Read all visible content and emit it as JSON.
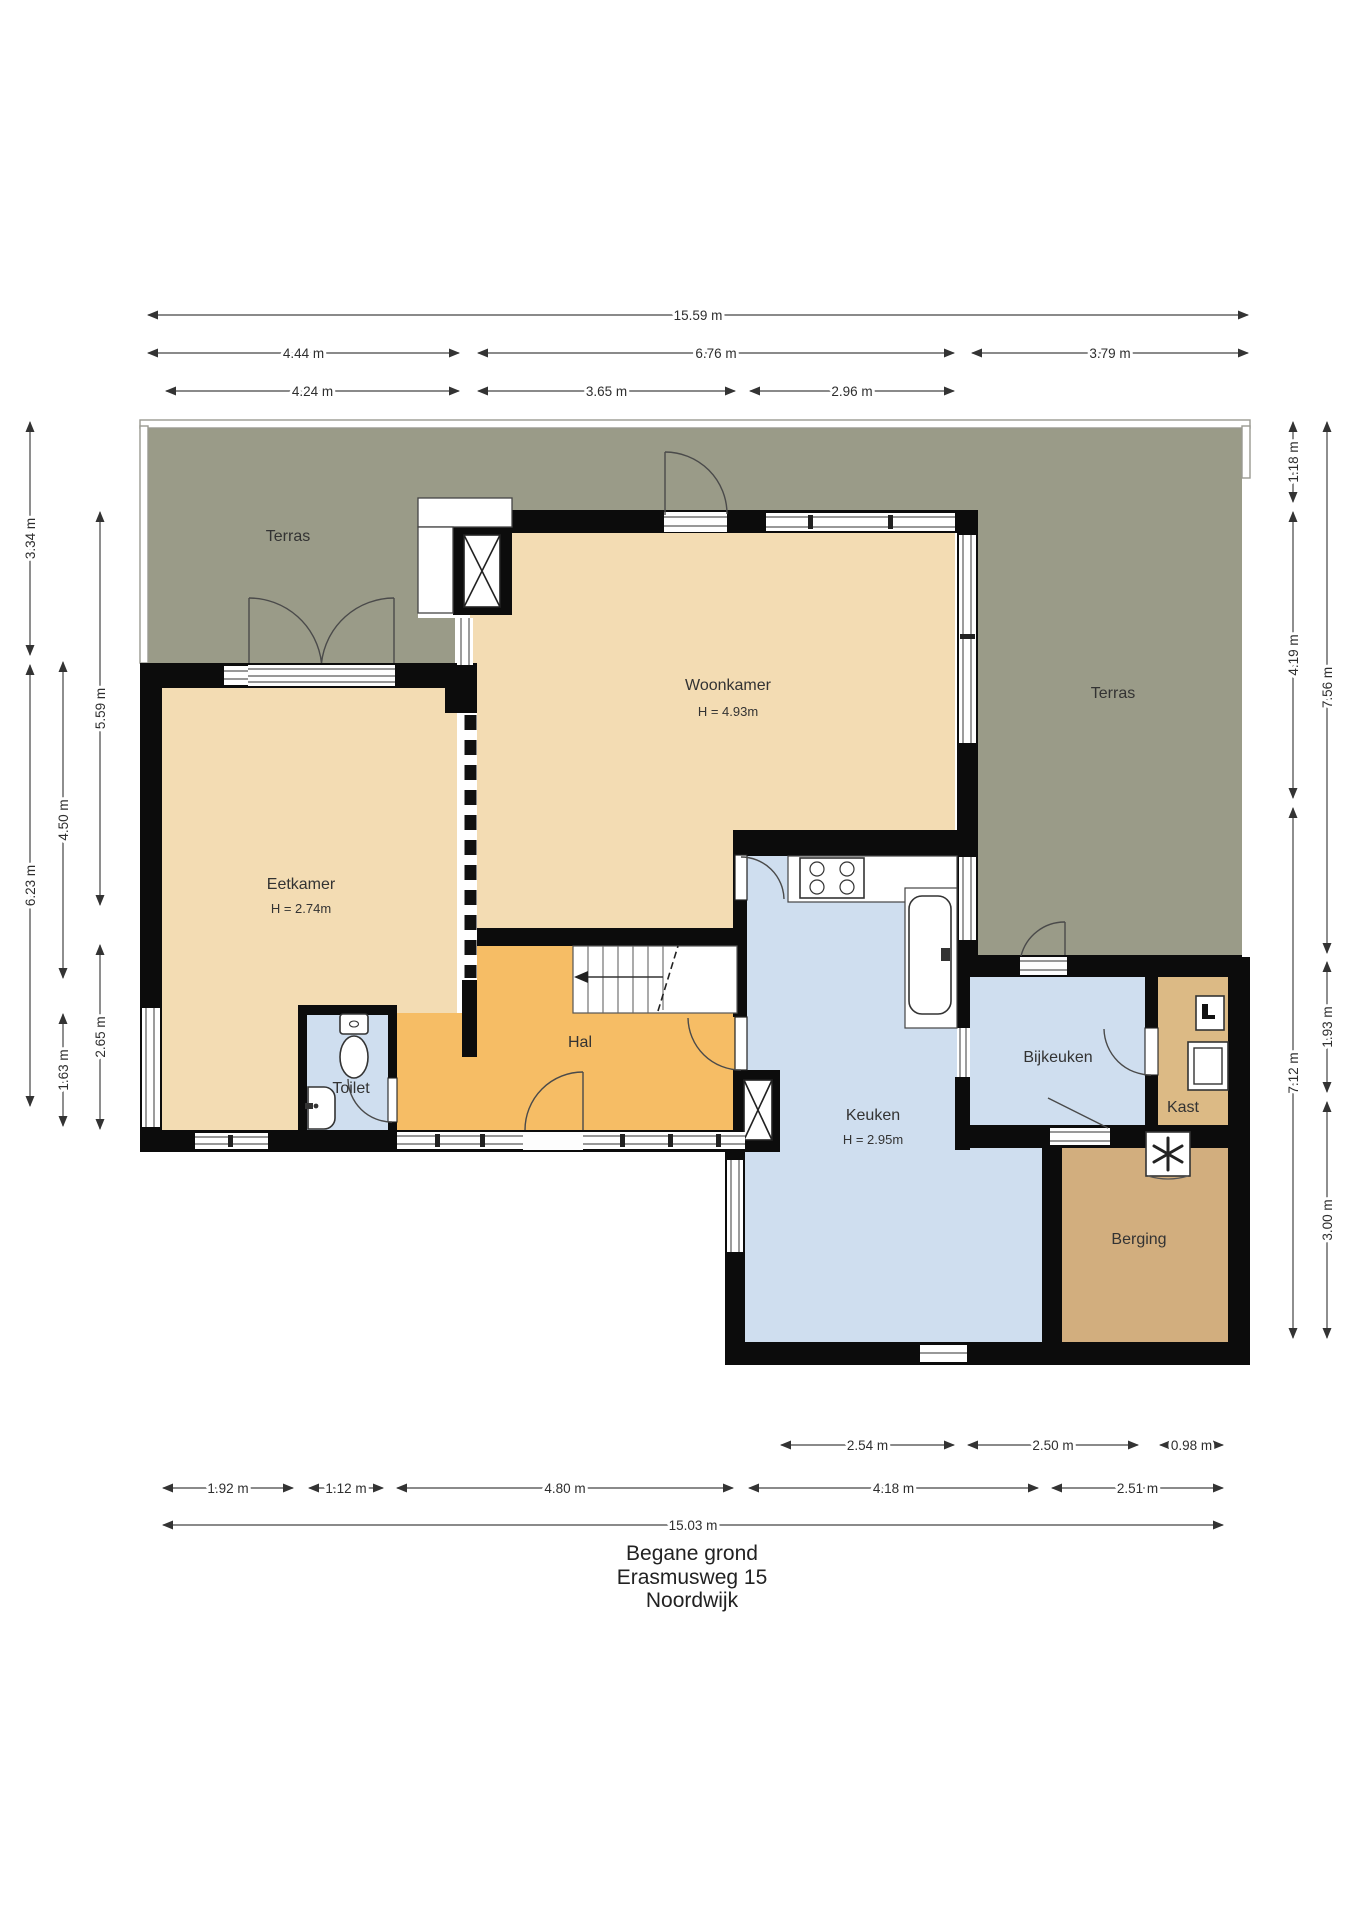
{
  "title": {
    "line1": "Begane grond",
    "line2": "Erasmusweg 15",
    "line3": "Noordwijk"
  },
  "rooms": [
    {
      "id": "terras-left",
      "label": "Terras",
      "x": 288,
      "y": 541
    },
    {
      "id": "terras-right",
      "label": "Terras",
      "x": 1113,
      "y": 698
    },
    {
      "id": "woonkamer",
      "label": "Woonkamer",
      "x": 728,
      "y": 690,
      "sub": "H = 4.93m",
      "subx": 728,
      "suby": 716
    },
    {
      "id": "eetkamer",
      "label": "Eetkamer",
      "x": 301,
      "y": 889,
      "sub": "H = 2.74m",
      "subx": 301,
      "suby": 913
    },
    {
      "id": "hal",
      "label": "Hal",
      "x": 580,
      "y": 1047
    },
    {
      "id": "toilet",
      "label": "Toilet",
      "x": 351,
      "y": 1093
    },
    {
      "id": "keuken",
      "label": "Keuken",
      "x": 873,
      "y": 1120,
      "sub": "H = 2.95m",
      "subx": 873,
      "suby": 1144
    },
    {
      "id": "bijkeuken",
      "label": "Bijkeuken",
      "x": 1058,
      "y": 1062
    },
    {
      "id": "kast",
      "label": "Kast",
      "x": 1183,
      "y": 1112
    },
    {
      "id": "berging",
      "label": "Berging",
      "x": 1139,
      "y": 1244
    }
  ],
  "dimensions_h": [
    {
      "label": "15.59 m",
      "x1": 146,
      "x2": 1250,
      "y": 315
    },
    {
      "label": "4.44 m",
      "x1": 146,
      "x2": 461,
      "y": 353
    },
    {
      "label": "6.76 m",
      "x1": 476,
      "x2": 956,
      "y": 353
    },
    {
      "label": "3.79 m",
      "x1": 970,
      "x2": 1250,
      "y": 353
    },
    {
      "label": "4.24 m",
      "x1": 164,
      "x2": 461,
      "y": 391
    },
    {
      "label": "3.65 m",
      "x1": 476,
      "x2": 737,
      "y": 391
    },
    {
      "label": "2.96 m",
      "x1": 748,
      "x2": 956,
      "y": 391
    },
    {
      "label": "2.54 m",
      "x1": 779,
      "x2": 956,
      "y": 1445
    },
    {
      "label": "2.50 m",
      "x1": 966,
      "x2": 1140,
      "y": 1445
    },
    {
      "label": "0.98 m",
      "x1": 1158,
      "x2": 1225,
      "y": 1445
    },
    {
      "label": "1.92 m",
      "x1": 161,
      "x2": 295,
      "y": 1488
    },
    {
      "label": "1.12 m",
      "x1": 307,
      "x2": 385,
      "y": 1488
    },
    {
      "label": "4.80 m",
      "x1": 395,
      "x2": 735,
      "y": 1488
    },
    {
      "label": "4.18 m",
      "x1": 747,
      "x2": 1040,
      "y": 1488
    },
    {
      "label": "2.51 m",
      "x1": 1050,
      "x2": 1225,
      "y": 1488
    },
    {
      "label": "15.03 m",
      "x1": 161,
      "x2": 1225,
      "y": 1525
    }
  ],
  "dimensions_v": [
    {
      "label": "3.34 m",
      "x": 30,
      "y1": 420,
      "y2": 657
    },
    {
      "label": "6.23 m",
      "x": 30,
      "y1": 663,
      "y2": 1108
    },
    {
      "label": "4.50 m",
      "x": 63,
      "y1": 660,
      "y2": 980
    },
    {
      "label": "1.63 m",
      "x": 63,
      "y1": 1012,
      "y2": 1128
    },
    {
      "label": "5.59 m",
      "x": 100,
      "y1": 510,
      "y2": 907
    },
    {
      "label": "2.65 m",
      "x": 100,
      "y1": 943,
      "y2": 1131
    },
    {
      "label": "1.18 m",
      "x": 1293,
      "y1": 420,
      "y2": 504
    },
    {
      "label": "4.19 m",
      "x": 1293,
      "y1": 510,
      "y2": 800
    },
    {
      "label": "7.12 m",
      "x": 1293,
      "y1": 806,
      "y2": 1340
    },
    {
      "label": "7.56 m",
      "x": 1327,
      "y1": 420,
      "y2": 955
    },
    {
      "label": "1.93 m",
      "x": 1327,
      "y1": 960,
      "y2": 1094
    },
    {
      "label": "3.00 m",
      "x": 1327,
      "y1": 1100,
      "y2": 1340
    }
  ],
  "colors": {
    "terrace": "#9a9b88",
    "room_beige": "#f3dcb3",
    "hall_orange": "#f6bd65",
    "wet_blue": "#cfdeef",
    "storage_tan": "#d2ae7e",
    "closet_tan": "#dcba85",
    "wall_black": "#0c0c0c",
    "outline_grey": "#9a9a92",
    "dim_color": "#2e2e2e",
    "label_color": "#333333"
  }
}
